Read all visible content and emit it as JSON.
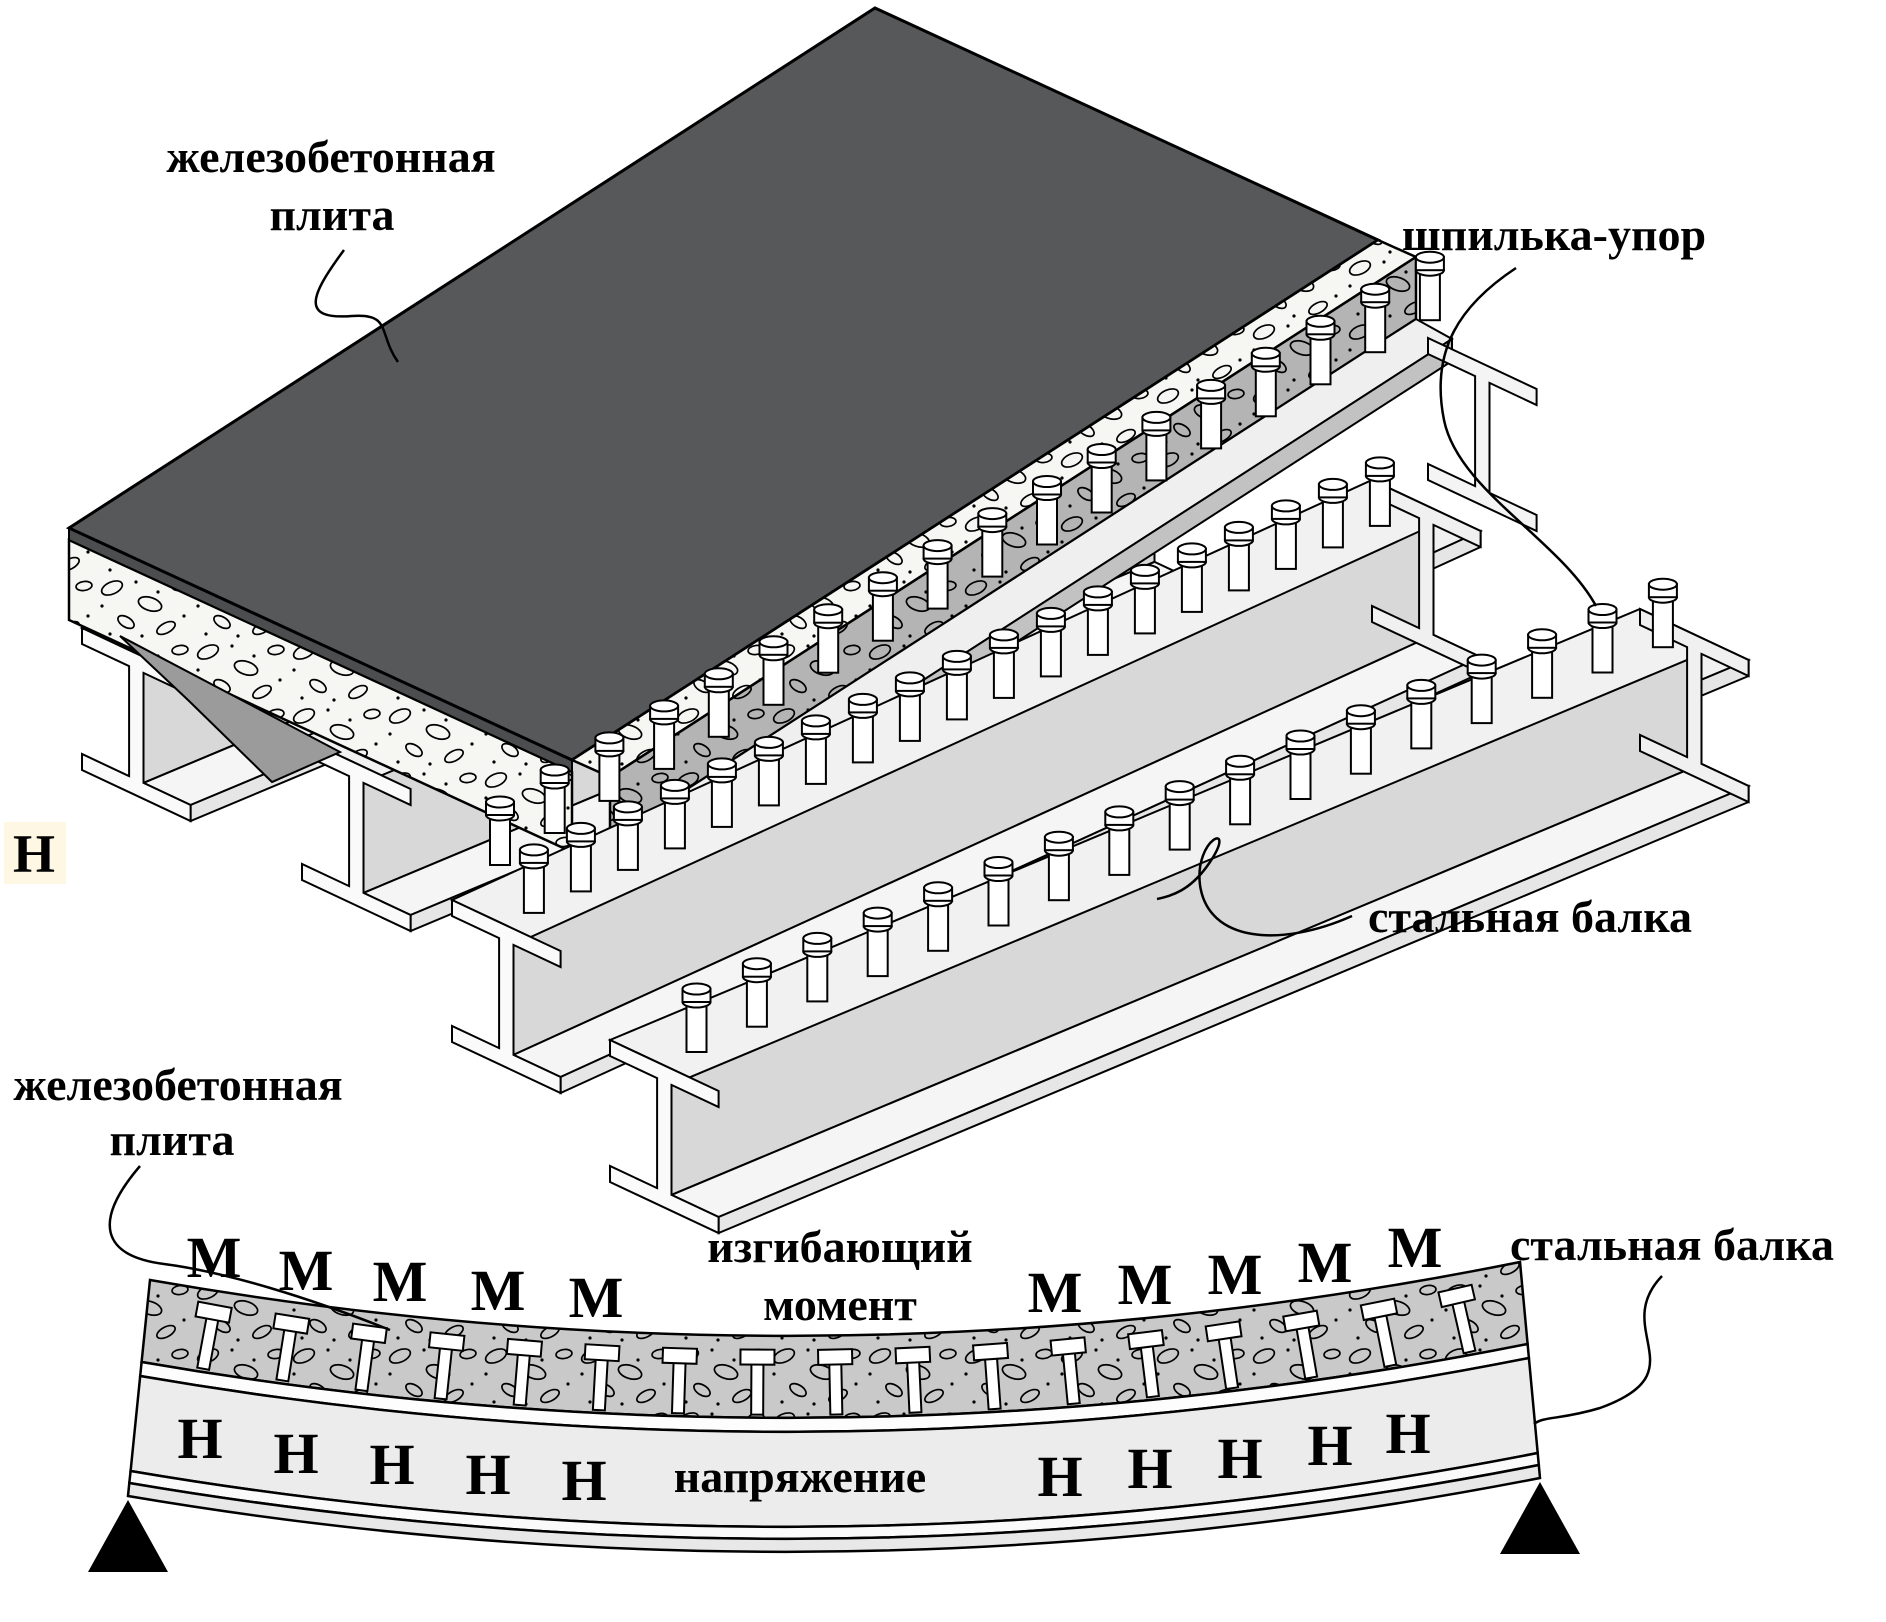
{
  "top_figure": {
    "slab_label_line1": "железобетонная",
    "slab_label_line2": "плита",
    "stud_label": "шпилька-упор",
    "beam_label": "стальная балка",
    "height_mark": "Н",
    "stud_counts": {
      "deck_row": 18,
      "middle_beam": 19,
      "front_beam": 17
    }
  },
  "bottom_figure": {
    "slab_label_line1": "железобетонная",
    "slab_label_line2": "плита",
    "beam_label": "стальная балка",
    "moment_caption_line1": "изгибающий",
    "moment_caption_line2": "момент",
    "stress_caption": "напряжение",
    "moment_letter": "М",
    "stress_letter": "Н",
    "moment_letter_count": 10,
    "stress_letter_count": 10,
    "stud_count": 17,
    "supports": 2
  },
  "colors": {
    "slab_dark": "#57585a",
    "concrete_light": "#f6f6f3",
    "concrete_cut": "#b4b4b4",
    "concrete_band": "#c9c9c9",
    "steel_end": "#fafafa",
    "steel_top": "#f1f1f1",
    "steel_front": "#e6e6e6",
    "steel_web": "#d8d8d8",
    "outline": "#000000",
    "highlight": "#fdf7e3"
  }
}
